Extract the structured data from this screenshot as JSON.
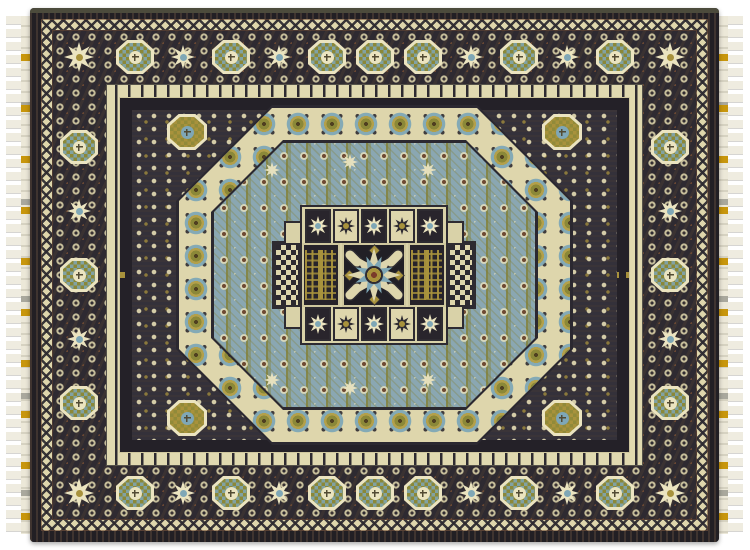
{
  "scene": {
    "type": "photograph",
    "subject": "Mamluk-style hand-knotted area rug",
    "description": "Top-down photograph of a rectangular Mamluk-style oriental rug on a white background. White fringe with gold thread accents runs along the left and right edges. A wide charcoal-navy main border holds alternating olive-green octagonal medallions and cream eight-point stars between cream zigzag and scroll guard bands. The inner navy field of cream floral sprigs frames a cream rosette band shaped as an octagon around a steel-blue field patterned with olive vines and dot clusters. At the center, a stepped cream panel holds a cross of tiles: a dark central square with a blue and cream starburst, flanked by gold lattice tree panels, checkered side panels, and rows of small star tiles.",
    "background_color_name": "white"
  },
  "palette": {
    "canvas": "#ffffff",
    "fringeIvory": "#efece0",
    "fringeGold": "#c8960c",
    "selvage": "#2a272c",
    "borderGround": "#2e2a31",
    "navyField": "#34313a",
    "cream": "#ded6ac",
    "creamBright": "#ebe4c0",
    "olive": "#8b8838",
    "gold": "#a8923c",
    "blue": "#7fa7b6",
    "fieldBlue": "#8aa7b2",
    "rust": "#6e4a33",
    "darkest": "#211f25"
  },
  "rug": {
    "fringe_sides": [
      "left",
      "right"
    ],
    "border_bands_outside_in": [
      "dark selvage",
      "cream zigzag guard",
      "main navy medallion border",
      "cream scroll guard",
      "gold dash band",
      "navy sprig field",
      "cream rosette octagon band",
      "blue octagon field",
      "central stepped cross medallion"
    ],
    "main_border_octagon_medallion_count": 22,
    "main_border_star_motif_count": 18,
    "field_corner_medallion_count": 4,
    "central_group": {
      "star_tile_rows": 2,
      "star_tiles_per_row": 5,
      "tree_panels": 2,
      "checker_panels": 2,
      "center_motif": "blue and cream eight-point starburst with gold ring core and four cream capsule cartouches"
    }
  },
  "ornaments": {
    "border_octagon_medallions": [
      [
        105,
        49
      ],
      [
        201,
        49
      ],
      [
        297,
        49
      ],
      [
        393,
        49
      ],
      [
        489,
        49
      ],
      [
        585,
        49
      ],
      [
        105,
        485
      ],
      [
        201,
        485
      ],
      [
        297,
        485
      ],
      [
        393,
        485
      ],
      [
        489,
        485
      ],
      [
        585,
        485
      ],
      [
        49,
        139
      ],
      [
        49,
        267
      ],
      [
        49,
        395
      ],
      [
        640,
        139
      ],
      [
        640,
        267
      ],
      [
        640,
        395
      ],
      [
        345,
        49
      ],
      [
        345,
        485
      ]
    ],
    "border_star_motifs": [
      [
        153,
        49
      ],
      [
        249,
        49
      ],
      [
        441,
        49
      ],
      [
        537,
        49
      ],
      [
        153,
        485
      ],
      [
        249,
        485
      ],
      [
        441,
        485
      ],
      [
        537,
        485
      ],
      [
        49,
        203
      ],
      [
        49,
        331
      ],
      [
        640,
        203
      ],
      [
        640,
        331
      ]
    ],
    "corner_star_motifs": [
      [
        49,
        49
      ],
      [
        640,
        49
      ],
      [
        49,
        485
      ],
      [
        640,
        485
      ]
    ],
    "field_corner_medallions": [
      [
        157,
        124
      ],
      [
        532,
        124
      ],
      [
        157,
        410
      ],
      [
        532,
        410
      ]
    ],
    "field_star_sprinkles": [
      [
        242,
        162
      ],
      [
        320,
        154
      ],
      [
        398,
        162
      ],
      [
        242,
        372
      ],
      [
        320,
        380
      ],
      [
        398,
        372
      ]
    ]
  }
}
